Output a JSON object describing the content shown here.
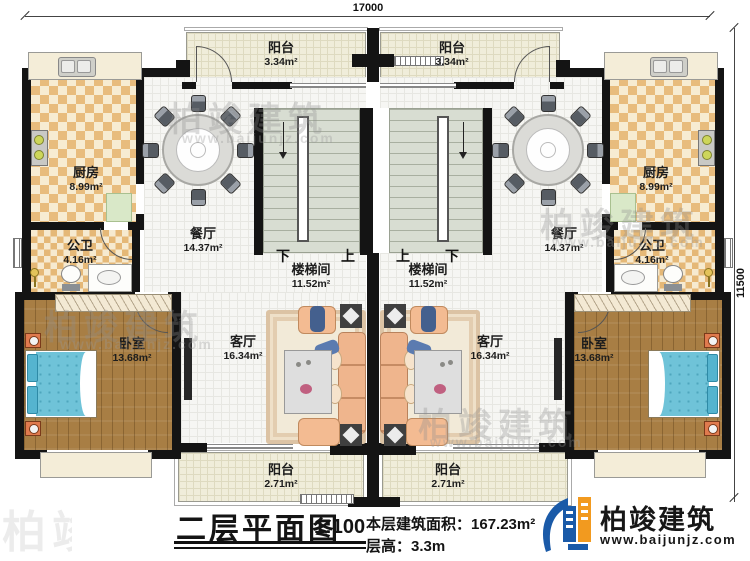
{
  "dims": {
    "top": "17000",
    "right": "11500"
  },
  "rooms": {
    "balcony_tl": {
      "name": "阳台",
      "area": "3.34m²"
    },
    "balcony_tr": {
      "name": "阳台",
      "area": "3.34m²"
    },
    "kitchen_l": {
      "name": "厨房",
      "area": "8.99m²"
    },
    "kitchen_r": {
      "name": "厨房",
      "area": "8.99m²"
    },
    "wc_l": {
      "name": "公卫",
      "area": "4.16m²"
    },
    "wc_r": {
      "name": "公卫",
      "area": "4.16m²"
    },
    "dining_l": {
      "name": "餐厅",
      "area": "14.37m²"
    },
    "dining_r": {
      "name": "餐厅",
      "area": "14.37m²"
    },
    "stair_l": {
      "name": "楼梯间",
      "area": "11.52m²"
    },
    "stair_r": {
      "name": "楼梯间",
      "area": "11.52m²"
    },
    "living_l": {
      "name": "客厅",
      "area": "16.34m²"
    },
    "living_r": {
      "name": "客厅",
      "area": "16.34m²"
    },
    "bedroom_l": {
      "name": "卧室",
      "area": "13.68m²"
    },
    "bedroom_r": {
      "name": "卧室",
      "area": "13.68m²"
    },
    "balcony_bl": {
      "name": "阳台",
      "area": "2.71m²"
    },
    "balcony_br": {
      "name": "阳台",
      "area": "2.71m²"
    }
  },
  "stair_marks": {
    "l_down": "下",
    "l_up": "上",
    "r_up": "上",
    "r_down": "下"
  },
  "title": {
    "main": "二层平面图",
    "scale": "1:100",
    "area_label": "本层建筑面积：",
    "area_value": "167.23m²",
    "height_label": "层高：",
    "height_value": "3.3m"
  },
  "brand": {
    "name": "柏竣建筑",
    "url": "www.baijunjz.com"
  },
  "watermark": {
    "text": "柏竣建筑",
    "url": "www.baijunjz.com"
  },
  "colors": {
    "wall": "#141414",
    "logo_blue": "#1a5aa8",
    "logo_orange": "#f29a1f",
    "bed": "#6fc3d8",
    "sofa": "#efb58d",
    "checker": "#e8bc7d"
  }
}
